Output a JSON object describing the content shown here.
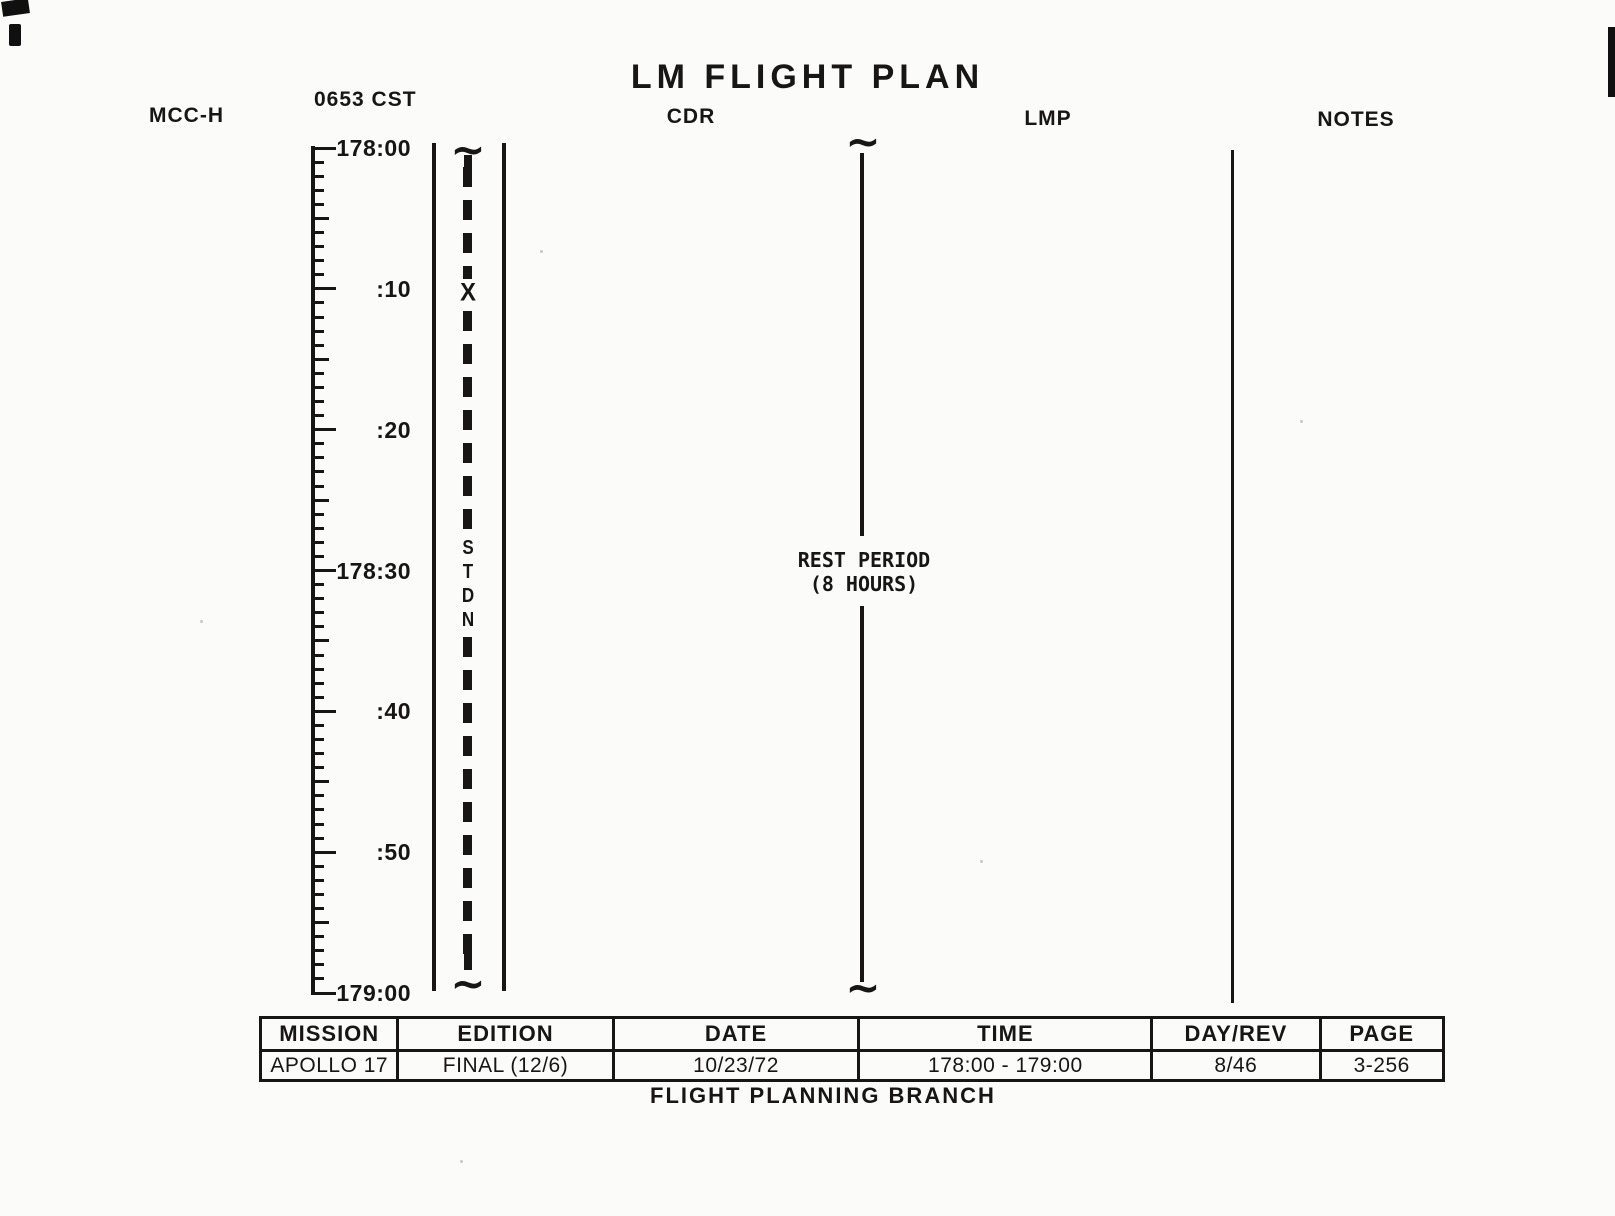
{
  "header": {
    "mcc_h": "MCC-H",
    "cst_time": "0653 CST",
    "title": "LM FLIGHT PLAN",
    "cdr": "CDR",
    "lmp": "LMP",
    "notes": "NOTES"
  },
  "timescale": {
    "labels": [
      "178:00",
      ":10",
      ":20",
      "178:30",
      ":40",
      ":50",
      "179:00"
    ],
    "minutes_total": 60,
    "minor_tick_every_minutes": 1,
    "mid_tick_every_minutes": 5,
    "label_every_minutes": 10
  },
  "stdn": {
    "x_marker": "X",
    "letters": [
      "S",
      "T",
      "D",
      "N"
    ]
  },
  "activity": {
    "line1": "REST PERIOD",
    "line2": "(8 HOURS)"
  },
  "symbols": {
    "continuation_squiggle": "~"
  },
  "footer_table": {
    "columns": [
      {
        "header": "MISSION",
        "value": "APOLLO 17"
      },
      {
        "header": "EDITION",
        "value": "FINAL (12/6)"
      },
      {
        "header": "DATE",
        "value": "10/23/72"
      },
      {
        "header": "TIME",
        "value": "178:00 - 179:00"
      },
      {
        "header": "DAY/REV",
        "value": "8/46"
      },
      {
        "header": "PAGE",
        "value": "3-256"
      }
    ],
    "caption": "FLIGHT PLANNING BRANCH"
  },
  "colors": {
    "ink": "#171614",
    "paper": "#fbfbf9"
  }
}
